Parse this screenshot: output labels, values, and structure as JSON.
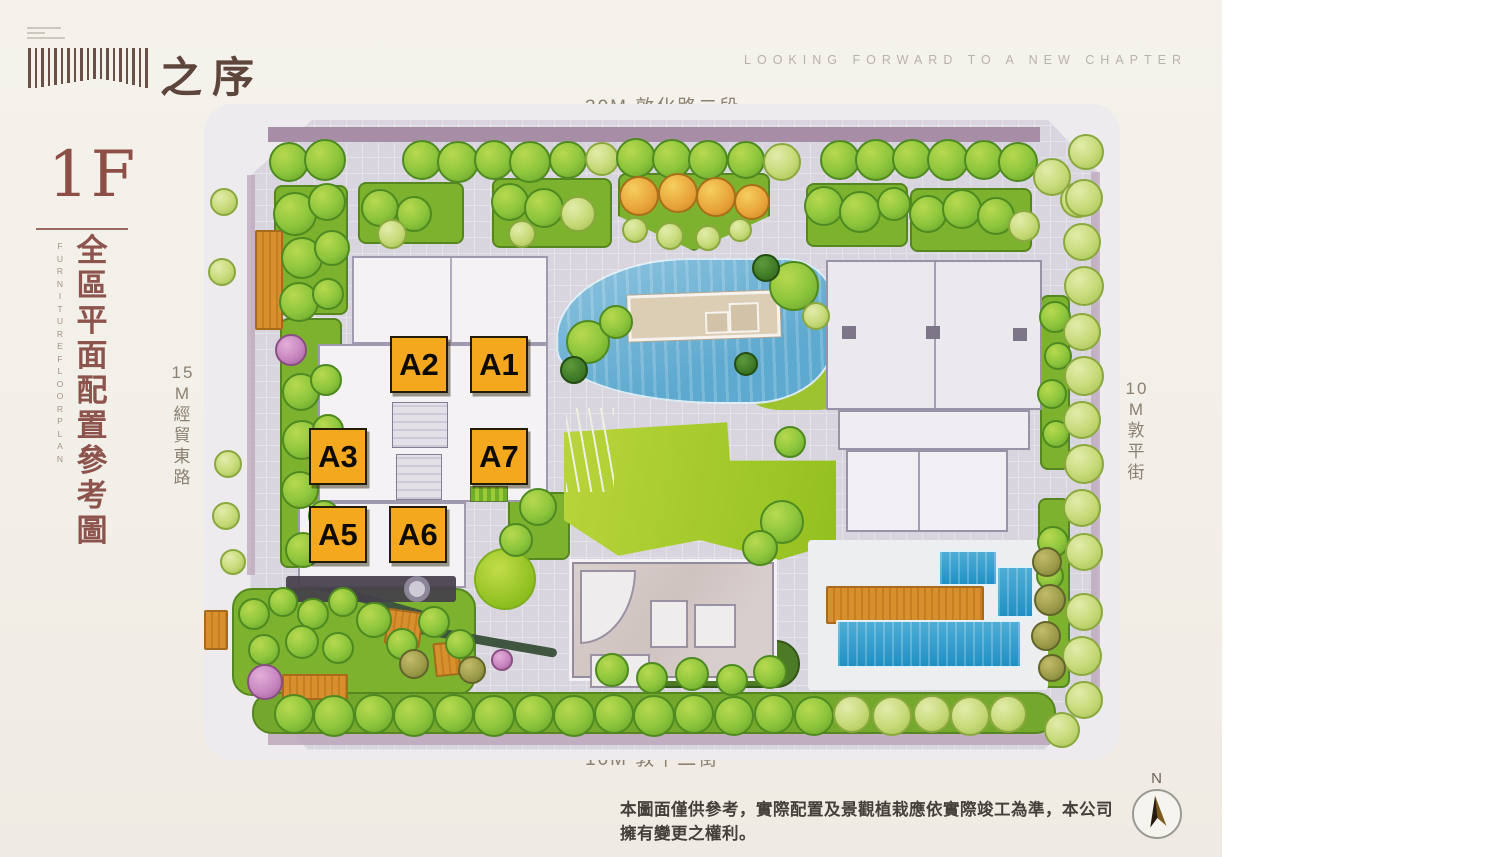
{
  "brand": {
    "logo_text": "之序",
    "tagline": "LOOKING FORWARD TO A NEW CHAPTER"
  },
  "title_block": {
    "floor": "1F",
    "title_zh": "全區平面配置參考圖",
    "title_en": "FURNITURE FLOOR PLAN"
  },
  "streets": {
    "north": "30M 敦化路二段",
    "west": "15M 經貿東路",
    "east": "10M 敦平街",
    "south": "10M 敦平二街"
  },
  "plan": {
    "unit_labels": [
      "A2",
      "A1",
      "A3",
      "A7",
      "A5",
      "A6"
    ],
    "compass_label": "N"
  },
  "footer": {
    "disclaimer": "本圖面僅供參考，實際配置及景觀植栽應依實際竣工為準，本公司擁有變更之權利。"
  },
  "colors": {
    "unit_label_bg": "#f4a81d",
    "title_maroon": "#8c544c",
    "pool_blue": "#2f9dce",
    "lawn_green": "#a6ce2f",
    "pond_blue": "#7fb9d9",
    "deck_orange": "#d8902f",
    "page_cream": "#f3f0ea"
  }
}
